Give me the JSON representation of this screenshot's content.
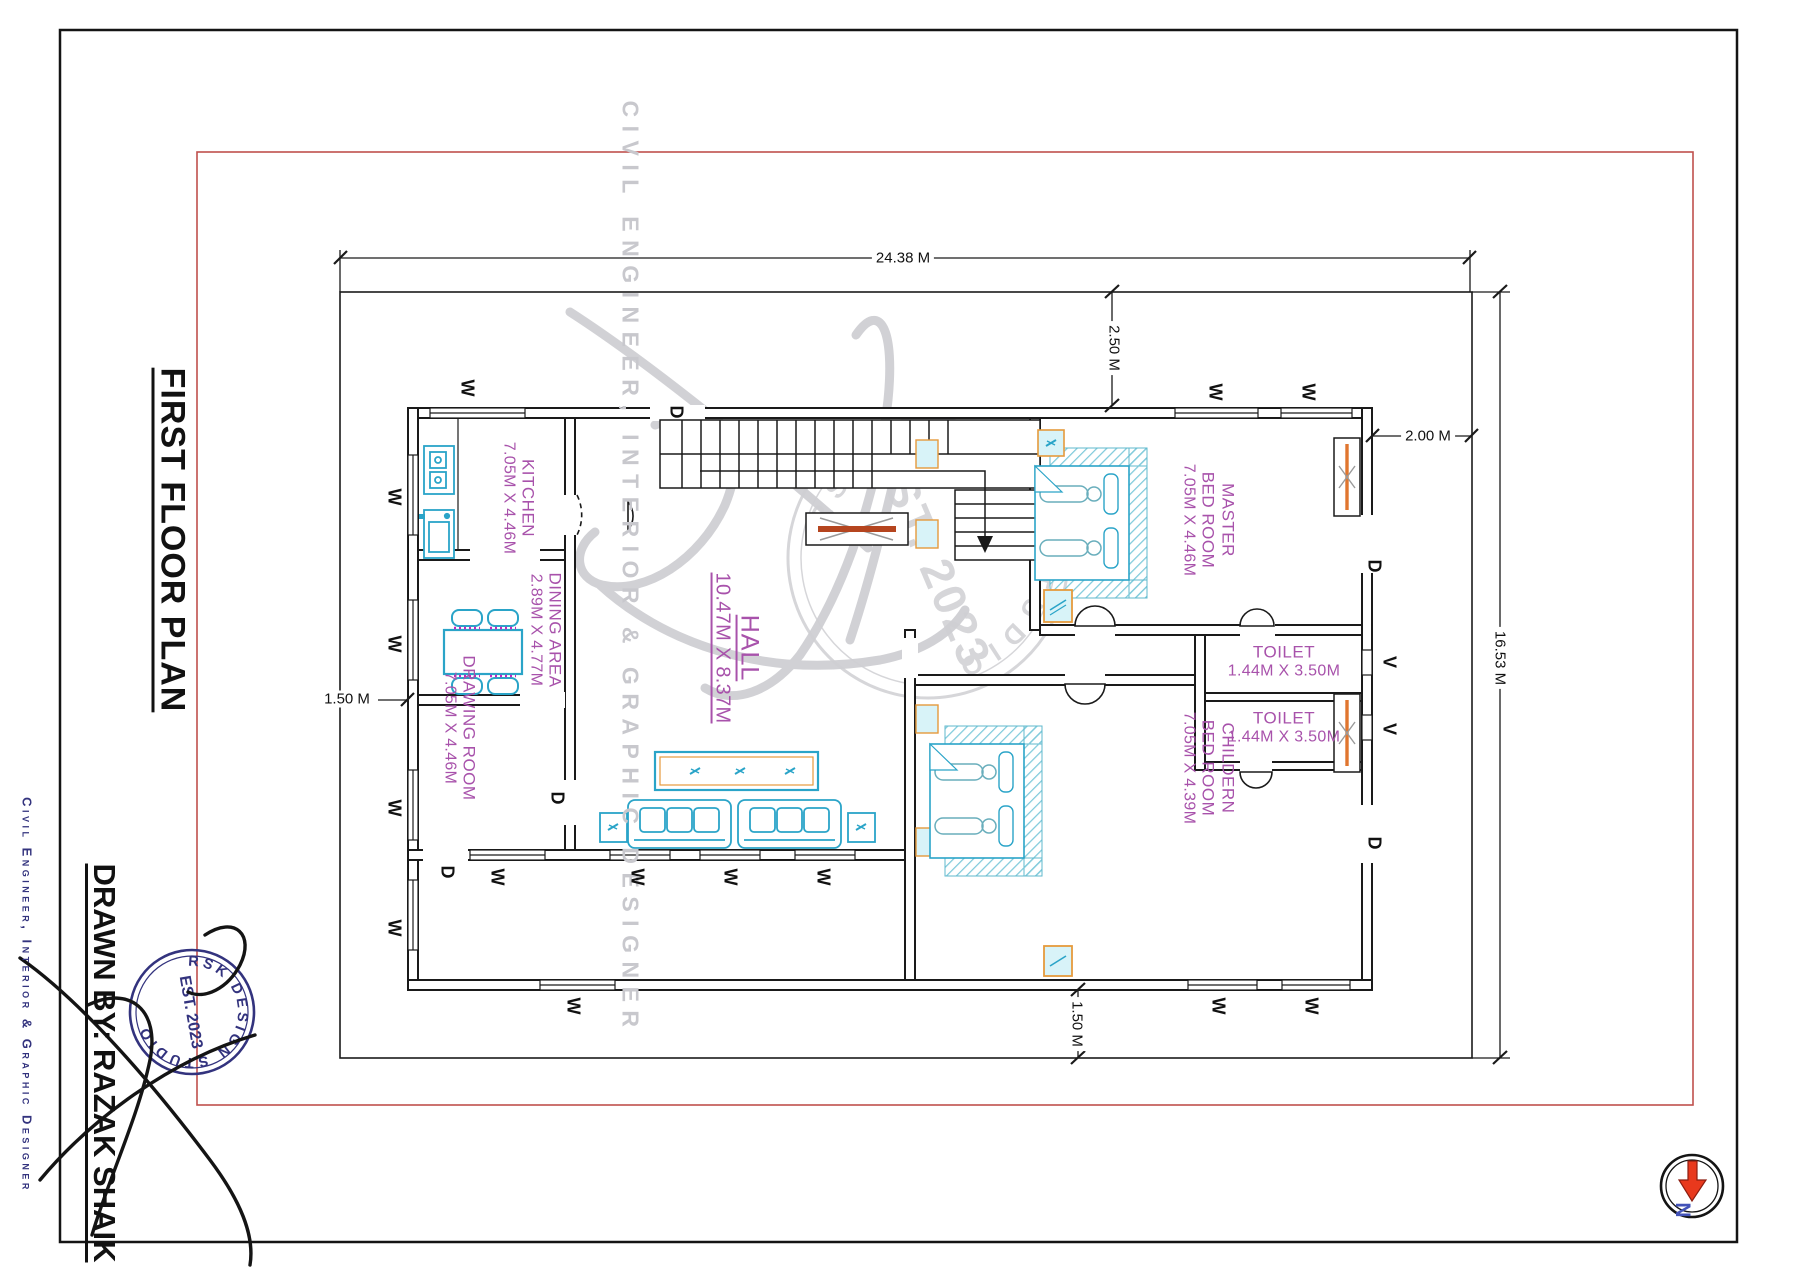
{
  "page": {
    "title_vertical": "FIRST FLOOR PLAN",
    "drawn_by_label": "DRAWN BY: RAZAK SHAIK",
    "side_caption": "Civil Engineer, Interior & Graphic Designer",
    "watermark_caption": "CIVIL ENGINEER, INTERIOR & GRAPHIC DESIGNER",
    "stamp": {
      "name": "RSK DESIGN STUDIO",
      "est": "EST. 2023"
    },
    "north_label": "N"
  },
  "colors": {
    "wall": "#1a1a1a",
    "room_text": "#a852ab",
    "furniture_cyan": "#2aa4c8",
    "accent_orange": "#e59a3c",
    "tv_sienna": "#b5451f",
    "red_border": "#c0504d",
    "navy": "#33337e",
    "watermark_gray": "#c8c8cd",
    "north_red": "#e8391d",
    "north_blue": "#4353b8"
  },
  "plan": {
    "rooms": [
      {
        "name": "KITCHEN",
        "dims": "7.05M X 4.46M",
        "cx": 518,
        "cy": 498,
        "rot": 90
      },
      {
        "name": "DINING AREA",
        "dims": "2.89M X 4.77M",
        "cx": 545,
        "cy": 630,
        "rot": 90
      },
      {
        "name": "DRAWING ROOM",
        "dims": "7.05M X 4.46M",
        "cx": 459,
        "cy": 728,
        "rot": 90
      },
      {
        "name": "HALL",
        "dims": "10.47M X 8.37M",
        "cx": 737,
        "cy": 648,
        "rot": 90,
        "big": true,
        "underline": true
      },
      {
        "name": "MASTER",
        "name2": "BED ROOM",
        "dims": "7.05M X 4.46M",
        "cx": 1208,
        "cy": 520,
        "rot": 90
      },
      {
        "name": "TOILET",
        "dims": "1.44M X 3.50M",
        "cx": 1284,
        "cy": 662,
        "rot": 0
      },
      {
        "name": "TOILET",
        "dims": "1.44M X 3.50M",
        "cx": 1284,
        "cy": 728,
        "rot": 0
      },
      {
        "name": "CHILDERN",
        "name2": "BED ROOM",
        "dims": "7.05M X 4.39M",
        "cx": 1208,
        "cy": 768,
        "rot": 90
      }
    ],
    "markers": [
      {
        "t": "W",
        "x": 467,
        "y": 388
      },
      {
        "t": "W",
        "x": 1215,
        "y": 392
      },
      {
        "t": "W",
        "x": 1308,
        "y": 392
      },
      {
        "t": "W",
        "x": 394,
        "y": 497
      },
      {
        "t": "W",
        "x": 394,
        "y": 644
      },
      {
        "t": "W",
        "x": 394,
        "y": 808
      },
      {
        "t": "W",
        "x": 394,
        "y": 928
      },
      {
        "t": "W",
        "x": 497,
        "y": 877
      },
      {
        "t": "W",
        "x": 637,
        "y": 877
      },
      {
        "t": "W",
        "x": 730,
        "y": 877
      },
      {
        "t": "W",
        "x": 823,
        "y": 877
      },
      {
        "t": "W",
        "x": 573,
        "y": 1006
      },
      {
        "t": "W",
        "x": 1218,
        "y": 1006
      },
      {
        "t": "W",
        "x": 1311,
        "y": 1006
      },
      {
        "t": "D",
        "x": 676,
        "y": 412
      },
      {
        "t": "D",
        "x": 447,
        "y": 872
      },
      {
        "t": "D",
        "x": 557,
        "y": 798
      },
      {
        "t": "D",
        "x": 1374,
        "y": 566
      },
      {
        "t": "D",
        "x": 1374,
        "y": 843
      },
      {
        "t": "V",
        "x": 1389,
        "y": 662
      },
      {
        "t": "V",
        "x": 1389,
        "y": 729
      }
    ],
    "dimensions": [
      {
        "text": "24.38 M",
        "cx": 903,
        "cy": 258,
        "rot": 0
      },
      {
        "text": "16.53 M",
        "cx": 1500,
        "cy": 658,
        "rot": 90
      },
      {
        "text": "2.50 M",
        "cx": 1114,
        "cy": 348,
        "rot": 90
      },
      {
        "text": "2.00 M",
        "cx": 1428,
        "cy": 436,
        "rot": 0
      },
      {
        "text": "1.50 M",
        "cx": 347,
        "cy": 699,
        "rot": 0
      },
      {
        "text": "1.50 M",
        "cx": 1077,
        "cy": 1024,
        "rot": 90
      }
    ]
  }
}
